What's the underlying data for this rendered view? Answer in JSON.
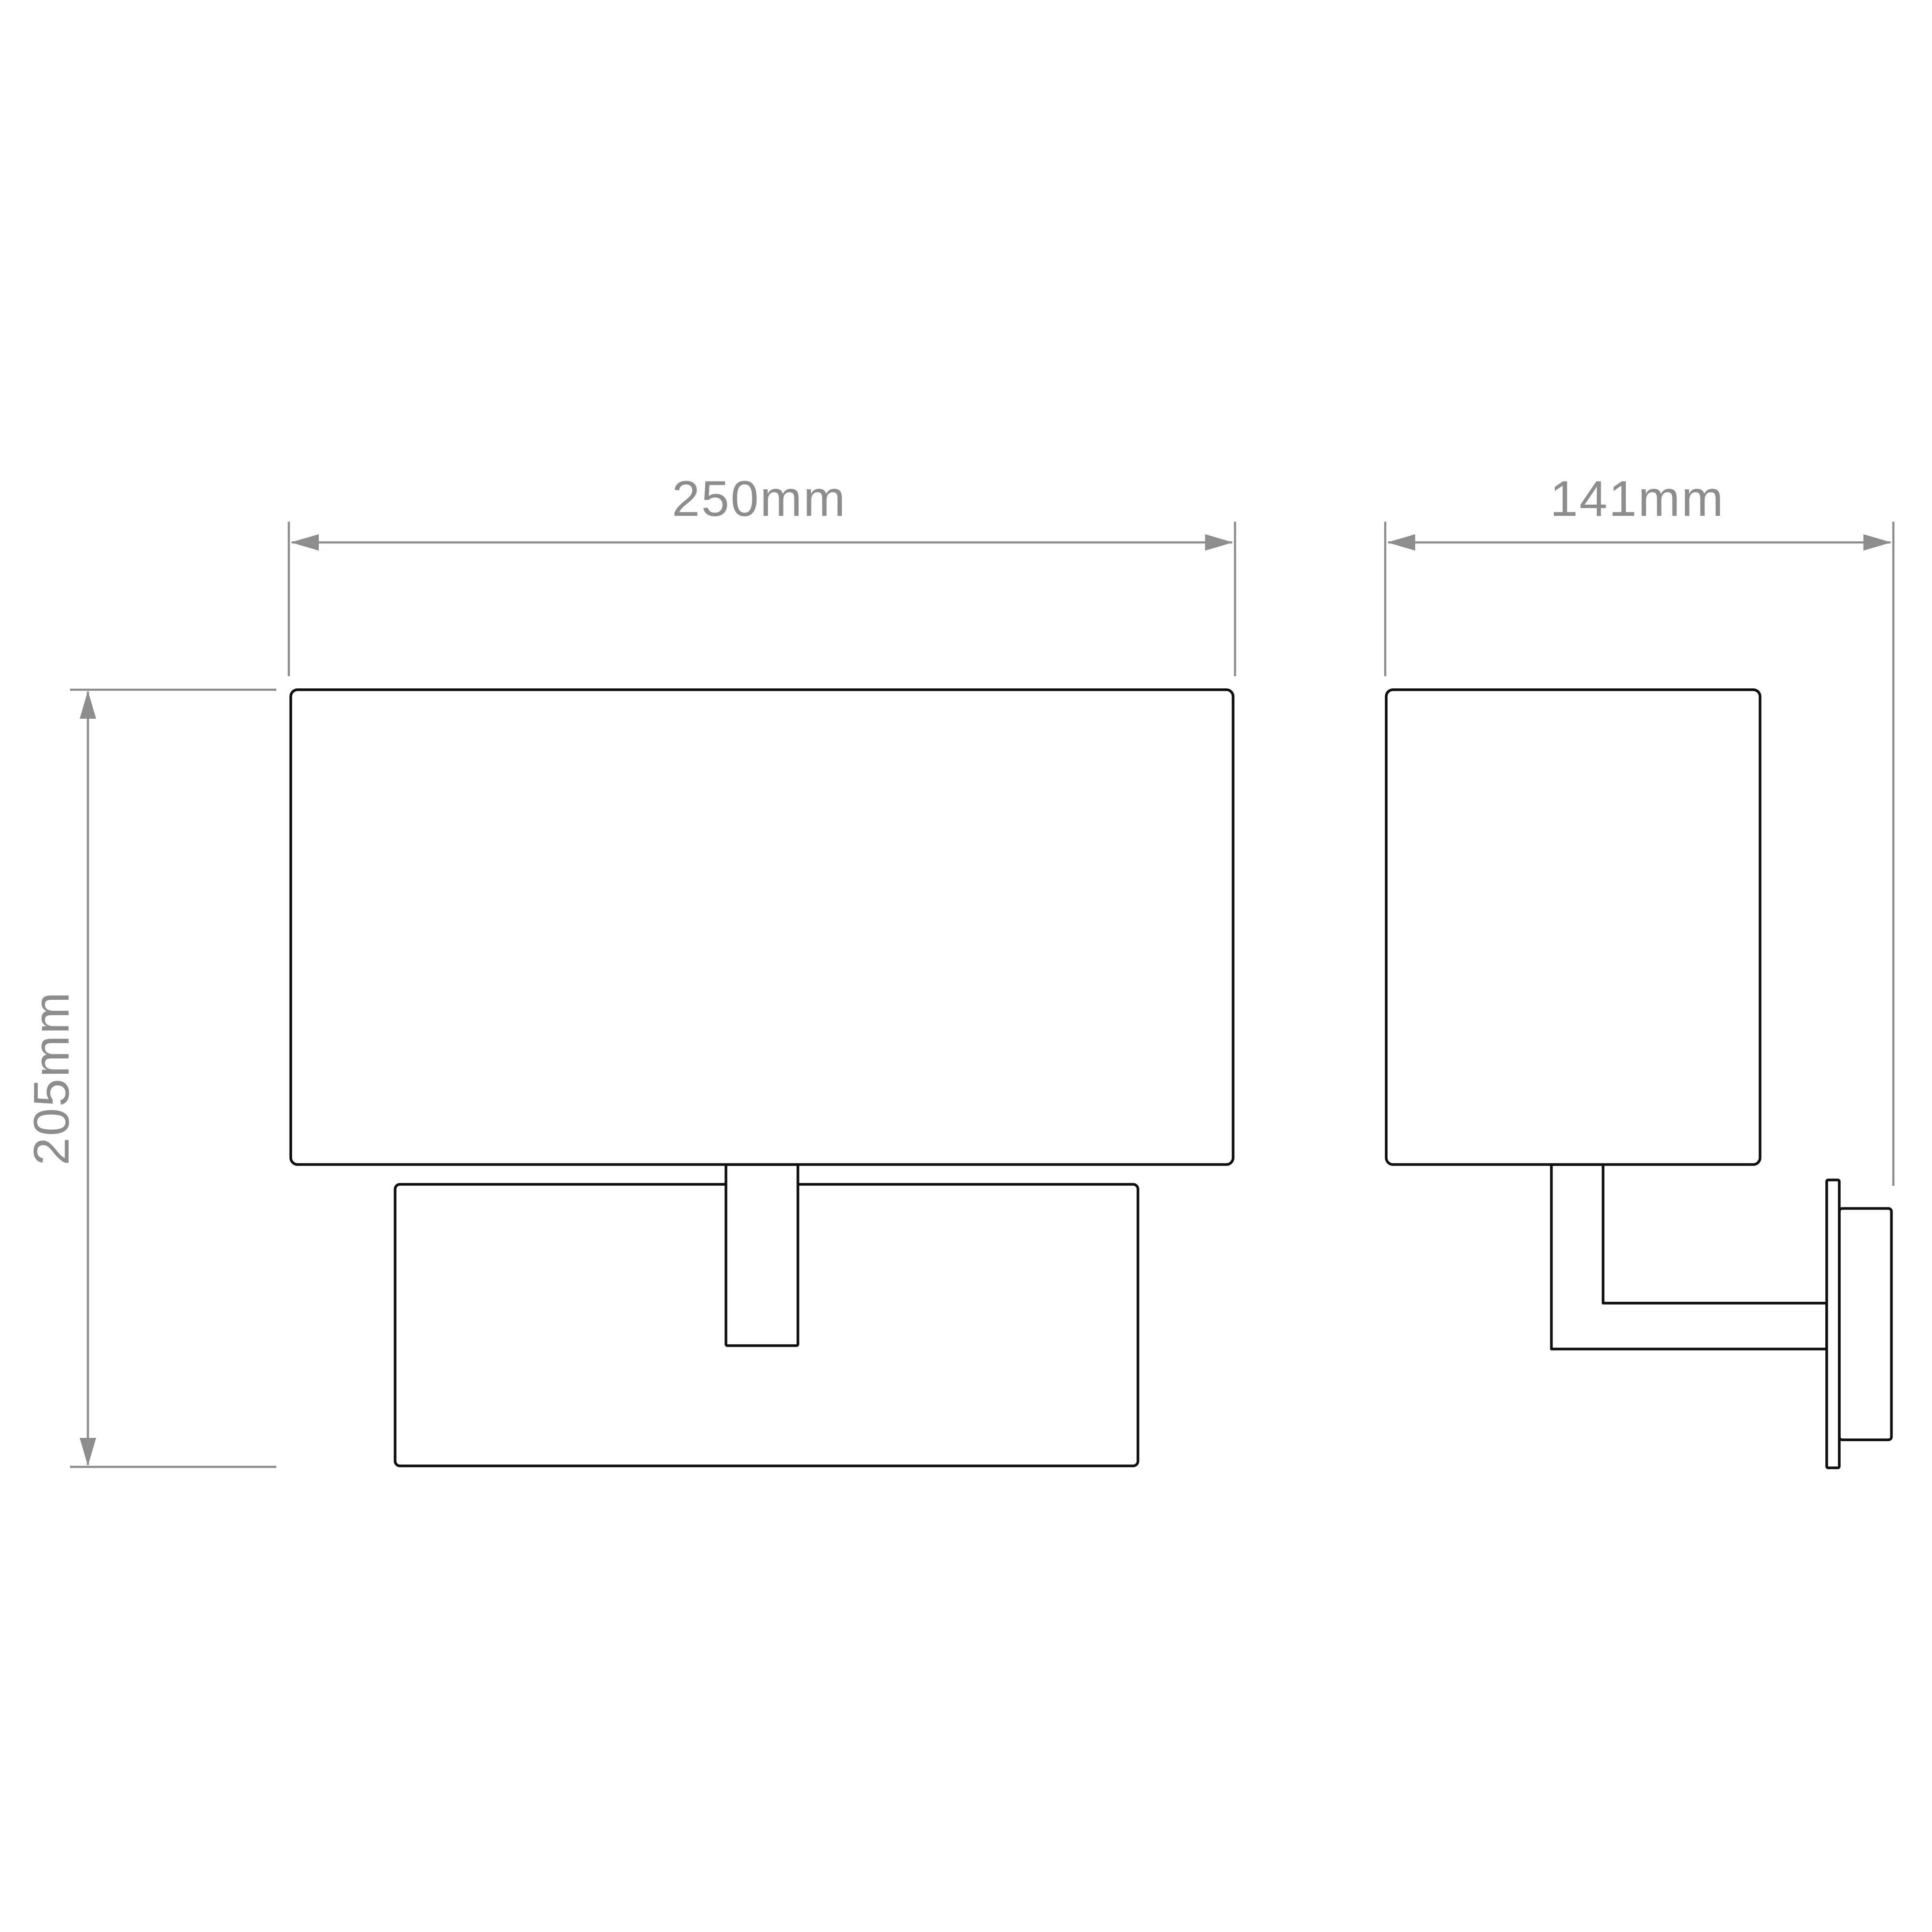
{
  "drawing": {
    "kind": "technical-dimension-diagram",
    "views": {
      "front": {
        "name": "front elevation"
      },
      "side": {
        "name": "side elevation"
      }
    },
    "dimensions": {
      "width": {
        "label": "250mm",
        "value_mm": 250,
        "orientation": "horizontal",
        "applies_to": "shade width, front view"
      },
      "depth": {
        "label": "141mm",
        "value_mm": 141,
        "orientation": "horizontal",
        "applies_to": "overall depth from shade front to wall, side view"
      },
      "height": {
        "label": "205mm",
        "value_mm": 205,
        "orientation": "vertical",
        "applies_to": "overall height, shade top to backplate bottom"
      }
    },
    "colors": {
      "line": "#0f0f0f",
      "dimension": "#8d8d8d",
      "text": "#8d8d8d",
      "background": "#ffffff"
    }
  }
}
